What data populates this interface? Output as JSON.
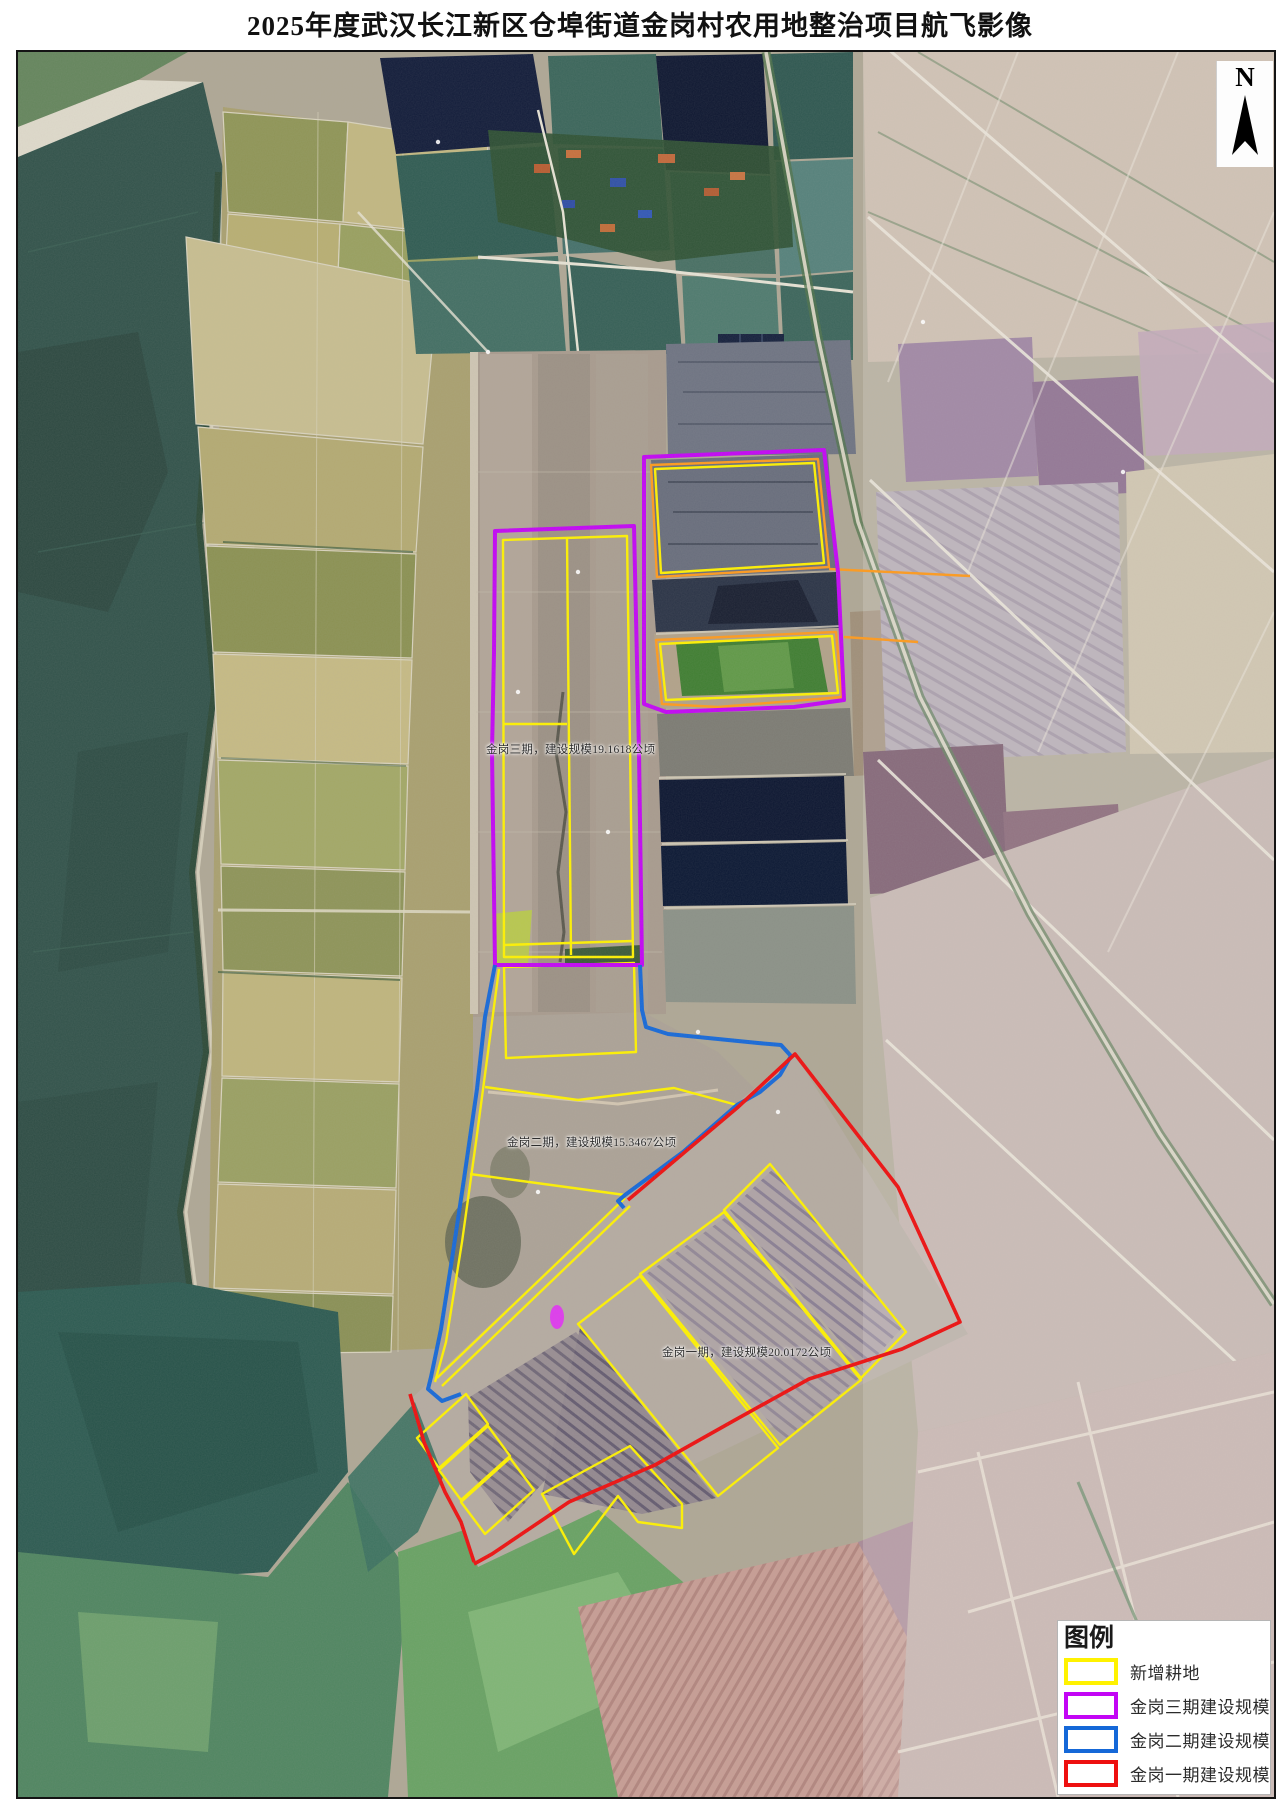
{
  "title": "2025年度武汉长江新区仓埠街道金岗村农用地整治项目航飞影像",
  "north_arrow": {
    "label": "N"
  },
  "map_annotations": {
    "phase3_label": "金岗三期，建设规模19.1618公顷",
    "phase2_label": "金岗二期，建设规模15.3467公顷",
    "phase1_label": "金岗一期，建设规模20.0172公顷"
  },
  "legend": {
    "title": "图例",
    "items": [
      {
        "label": "新增耕地",
        "color": "#FFF200"
      },
      {
        "label": "金岗三期建设规模",
        "color": "#C305F5"
      },
      {
        "label": "金岗二期建设规模",
        "color": "#1568D8"
      },
      {
        "label": "金岗一期建设规模",
        "color": "#EE0F0F"
      }
    ]
  },
  "overlay_colors": {
    "new_farmland": "#FFF200",
    "phase3": "#C305F5",
    "phase2": "#1568D8",
    "phase1": "#EE0F0F",
    "orange_plots": "#FF9A1C"
  }
}
